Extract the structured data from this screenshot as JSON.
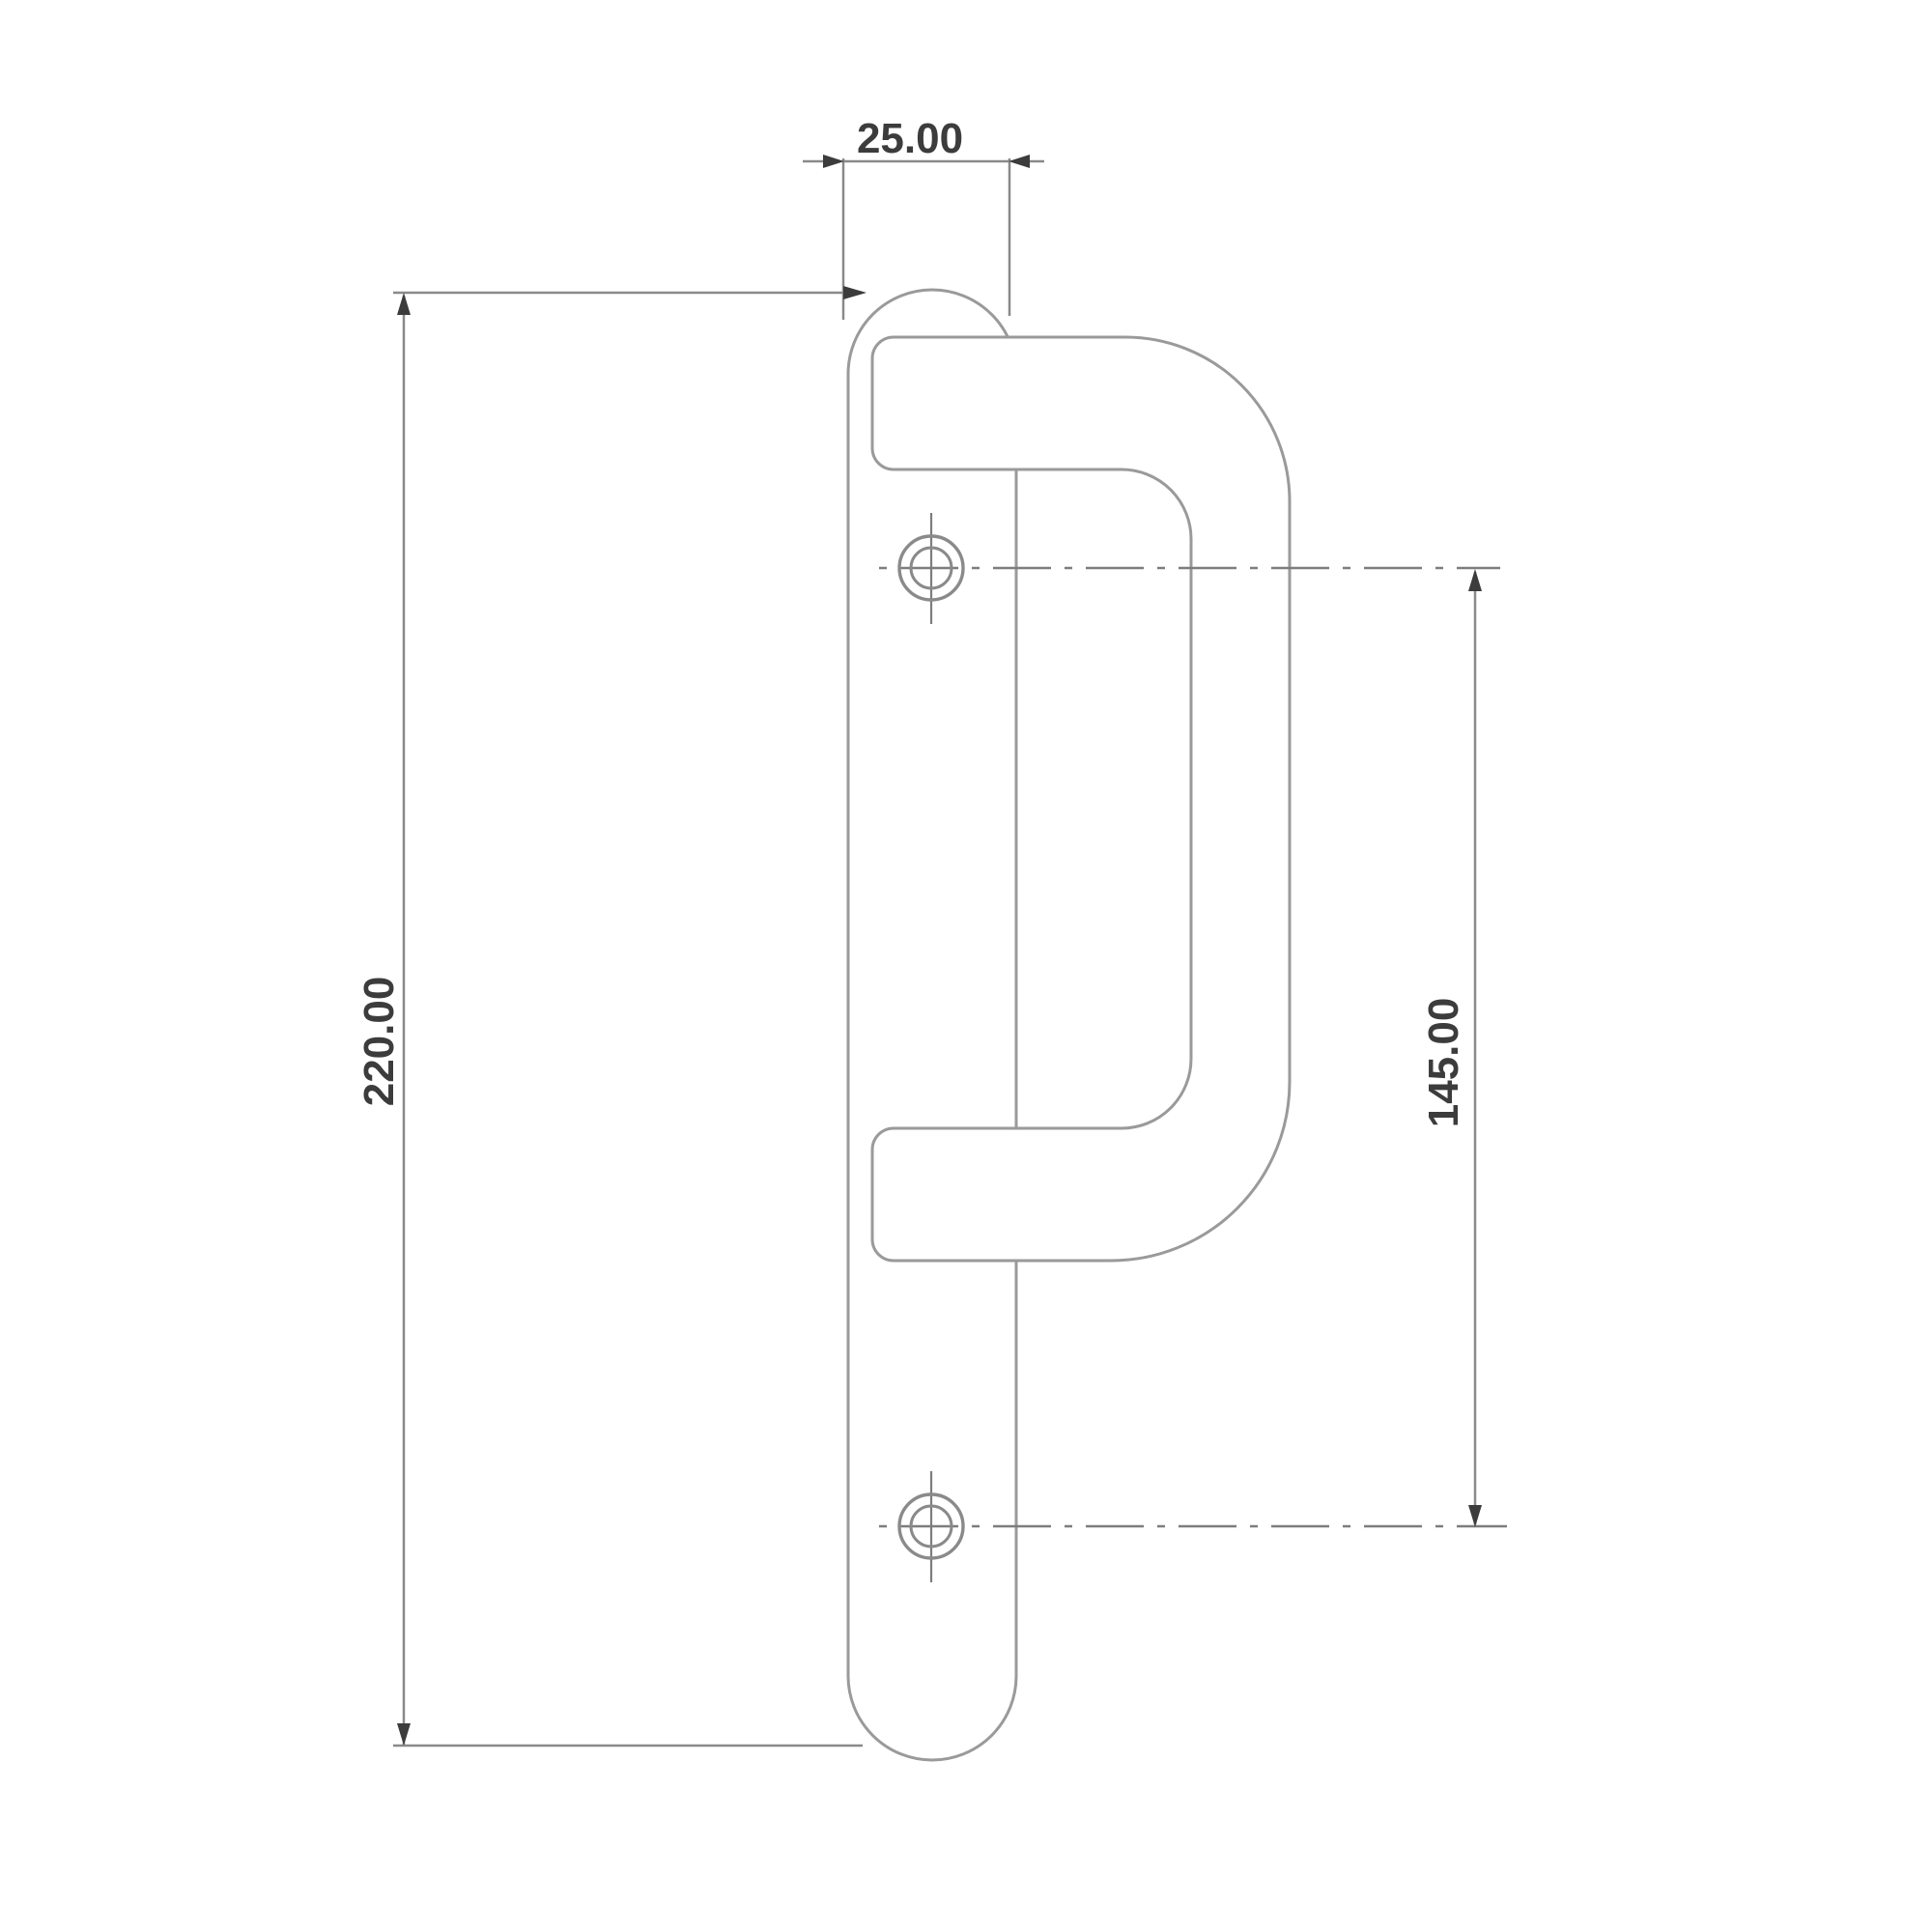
{
  "drawing": {
    "type": "technical-dimension-drawing",
    "subject": "door handle side profile with backplate and D-grip",
    "units_shown": "decimal",
    "dimensions": {
      "plate_width": {
        "value": "25.00"
      },
      "plate_height": {
        "value": "220.00"
      },
      "screw_spacing": {
        "value": "145.00"
      }
    },
    "features": {
      "screw_holes": 2,
      "screw_hole_style": "crosshair target",
      "centerline_style": "dash-dot"
    },
    "colors": {
      "background": "#ffffff",
      "object_line": "#9a9a9a",
      "dimension_line": "#8a8a8a",
      "centerline": "#7d7d7d",
      "arrow": "#3c3c3c",
      "text": "#3c3c3c"
    }
  }
}
